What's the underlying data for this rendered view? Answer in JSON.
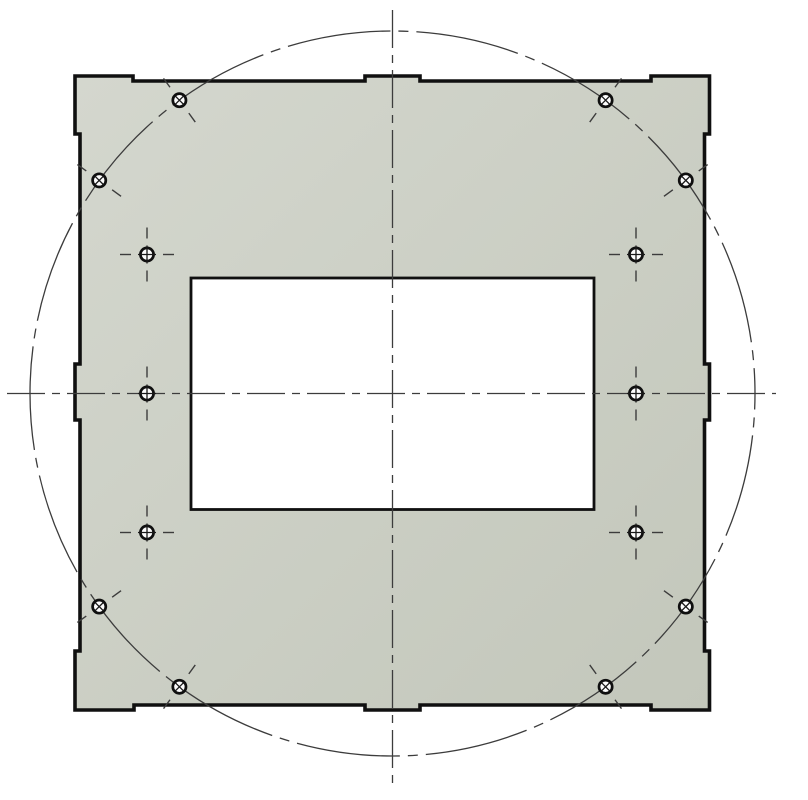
{
  "drawing": {
    "canvas": {
      "width": 808,
      "height": 800,
      "background": "#ffffff"
    },
    "colors": {
      "plate_fill_light": "#d4d7ce",
      "plate_fill_dark": "#c3c7bb",
      "outline": "#101010",
      "thin_line": "#3c3c3c",
      "hole_ring": "#0f0f0f",
      "hole_fill": "#fdfdfd",
      "hole_cross": "#1a1a1a",
      "cutout_fill": "#ffffff"
    },
    "plate": {
      "name": "plate-outline",
      "stroke_width": 3.6,
      "outline_points": [
        [
          75,
          76
        ],
        [
          133,
          76
        ],
        [
          133,
          81
        ],
        [
          365,
          81
        ],
        [
          365,
          76
        ],
        [
          420,
          76
        ],
        [
          420,
          81
        ],
        [
          651,
          81
        ],
        [
          651,
          76
        ],
        [
          709.5,
          76
        ],
        [
          709.5,
          134
        ],
        [
          704.5,
          134
        ],
        [
          704.5,
          364
        ],
        [
          709.5,
          364
        ],
        [
          709.5,
          420
        ],
        [
          704.5,
          420
        ],
        [
          704.5,
          651
        ],
        [
          709.5,
          651
        ],
        [
          709.5,
          710
        ],
        [
          651,
          710
        ],
        [
          651,
          705
        ],
        [
          420,
          705
        ],
        [
          420,
          710
        ],
        [
          365,
          710
        ],
        [
          365,
          705
        ],
        [
          134,
          705
        ],
        [
          134,
          710
        ],
        [
          75,
          710
        ],
        [
          75,
          651
        ],
        [
          80,
          651
        ],
        [
          80,
          420
        ],
        [
          75,
          420
        ],
        [
          75,
          364
        ],
        [
          80,
          364
        ],
        [
          80,
          134
        ],
        [
          75,
          134
        ]
      ]
    },
    "cutout": {
      "name": "center-cutout",
      "x": 191,
      "y": 278,
      "width": 403,
      "height": 231.5,
      "stroke_width": 2.8
    },
    "bolt_circle": {
      "name": "bolt-circle",
      "cx": 392.5,
      "cy": 393.5,
      "r": 362.5,
      "stroke_width": 1.3,
      "dash": "104 8 10 8",
      "dash_offset": -42
    },
    "centerlines": [
      {
        "name": "vertical-centerline",
        "x1": 392.5,
        "y1": 10,
        "x2": 392.5,
        "y2": 787,
        "dash": "38 7 8 7",
        "stroke_width": 1.3
      },
      {
        "name": "horizontal-centerline",
        "x1": 7,
        "y1": 393.5,
        "x2": 776,
        "y2": 393.5,
        "dash": "38 7 8 7",
        "stroke_width": 1.3
      }
    ],
    "hole_style": {
      "ring_radius": 6.6,
      "ring_stroke": 2.7,
      "cross_stroke": 1.3,
      "cross_half_plus": 9,
      "cross_half_x": 4.1,
      "tick_stroke": 1.4,
      "tick_from": 16,
      "tick_to": 27
    },
    "bolt_holes": [
      {
        "name": "bolt-hole-top-left",
        "cx": 179.4,
        "cy": 100.2,
        "angle_deg": -126
      },
      {
        "name": "bolt-hole-left-top",
        "cx": 99.2,
        "cy": 180.4,
        "angle_deg": -144
      },
      {
        "name": "bolt-hole-top-right",
        "cx": 605.6,
        "cy": 100.2,
        "angle_deg": -54
      },
      {
        "name": "bolt-hole-right-top",
        "cx": 685.8,
        "cy": 180.4,
        "angle_deg": -36
      },
      {
        "name": "bolt-hole-right-bottom",
        "cx": 685.8,
        "cy": 606.6,
        "angle_deg": 36
      },
      {
        "name": "bolt-hole-bottom-right",
        "cx": 605.6,
        "cy": 686.8,
        "angle_deg": 54
      },
      {
        "name": "bolt-hole-bottom-left",
        "cx": 179.4,
        "cy": 686.8,
        "angle_deg": 126
      },
      {
        "name": "bolt-hole-left-bottom",
        "cx": 99.2,
        "cy": 606.6,
        "angle_deg": 144
      }
    ],
    "mount_holes": [
      {
        "name": "mount-hole-upper-left",
        "cx": 147,
        "cy": 254.5,
        "row": "top"
      },
      {
        "name": "mount-hole-upper-right",
        "cx": 636,
        "cy": 254.5,
        "row": "top"
      },
      {
        "name": "mount-hole-middle-left",
        "cx": 147,
        "cy": 393.5,
        "row": "middle"
      },
      {
        "name": "mount-hole-middle-right",
        "cx": 636,
        "cy": 393.5,
        "row": "middle"
      },
      {
        "name": "mount-hole-lower-left",
        "cx": 147,
        "cy": 532.5,
        "row": "bottom"
      },
      {
        "name": "mount-hole-lower-right",
        "cx": 636,
        "cy": 532.5,
        "row": "bottom"
      }
    ]
  }
}
